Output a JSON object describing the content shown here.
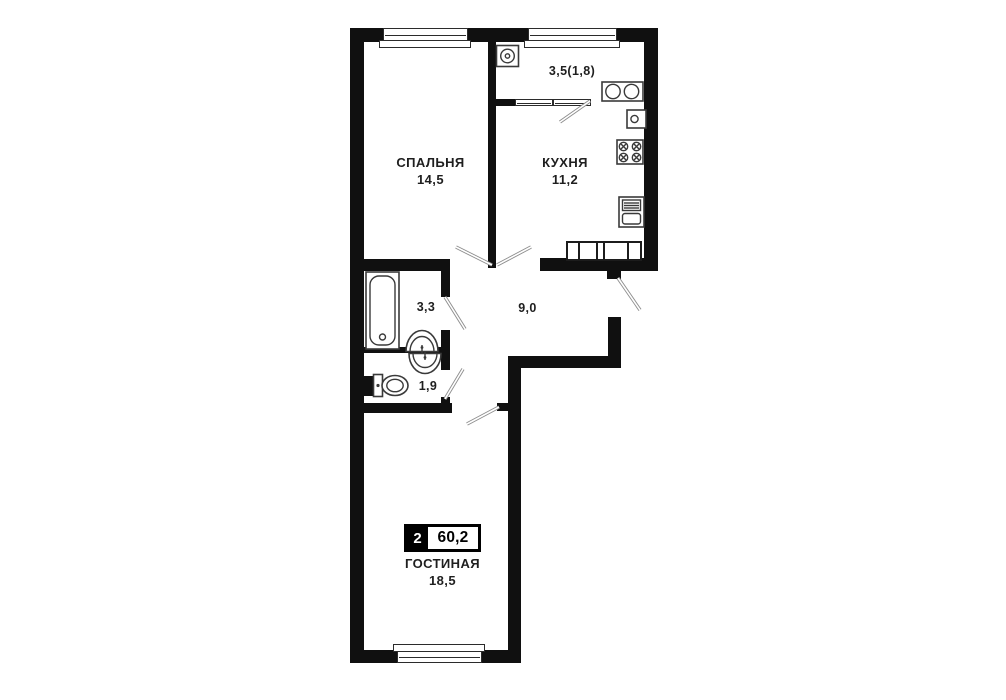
{
  "plan_type": "apartment-floor-plan",
  "colors": {
    "wall": "#101010",
    "background": "#ffffff",
    "text": "#1f1f1f",
    "badge_bg": "#000000",
    "badge_text": "#ffffff",
    "door_line": "#8d8d8d"
  },
  "badge": {
    "rooms": "2",
    "total_area": "60,2"
  },
  "rooms": {
    "bedroom": {
      "label": "СПАЛЬНЯ",
      "area": "14,5"
    },
    "kitchen": {
      "label": "КУХНЯ",
      "area": "11,2"
    },
    "living": {
      "label": "ГОСТИНАЯ",
      "area": "18,5"
    },
    "balcony": {
      "area": "3,5(1,8)"
    },
    "bathroom": {
      "area": "3,3"
    },
    "hallway": {
      "area": "9,0"
    },
    "wc": {
      "area": "1,9"
    }
  },
  "fixtures": [
    "washing-machine",
    "double-sink",
    "kitchen-sink",
    "stove",
    "fridge",
    "built-in-closet",
    "bathtub",
    "wash-basin-bathroom",
    "wash-basin-wc",
    "toilet"
  ]
}
